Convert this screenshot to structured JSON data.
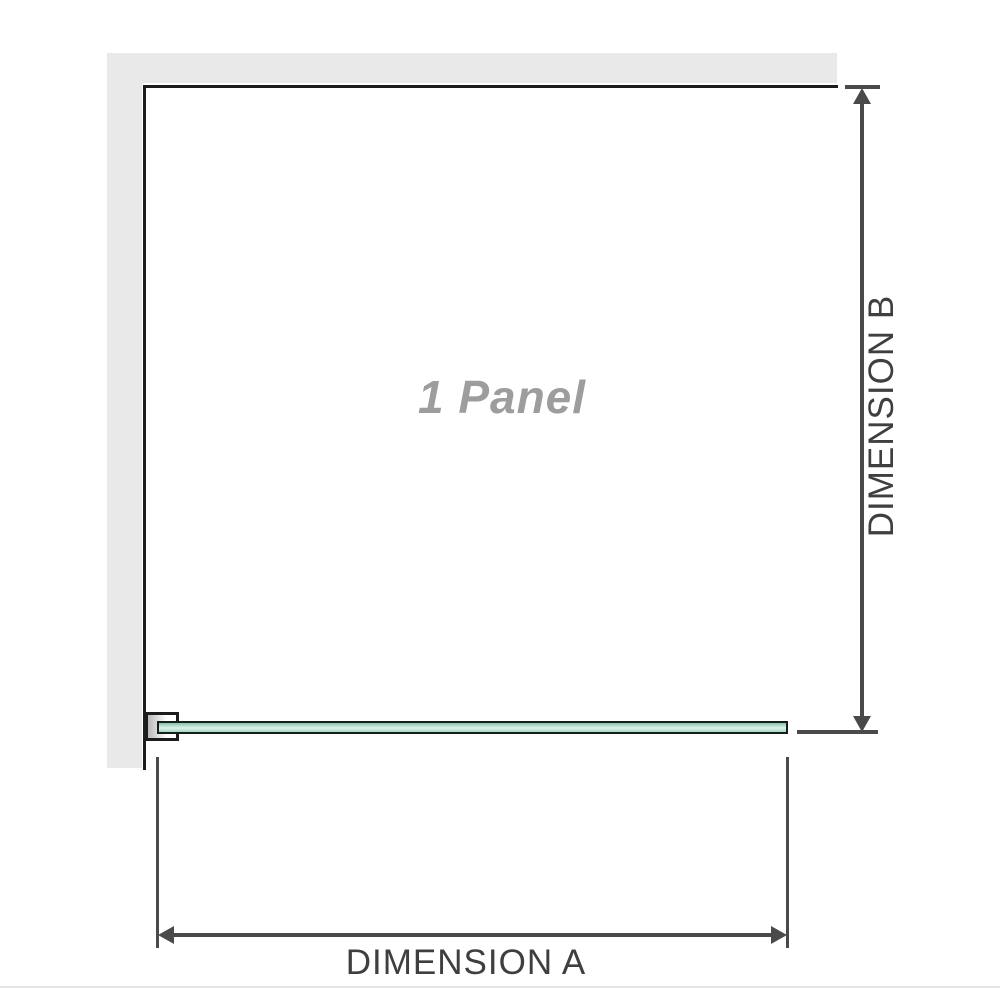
{
  "diagram": {
    "panel_label": "1 Panel",
    "dimension_a": {
      "label": "DIMENSION A"
    },
    "dimension_b": {
      "label": "DIMENSION B"
    }
  },
  "colors": {
    "background": "#ffffff",
    "wall_fill": "#e9e9e9",
    "outline": "#1c1c1c",
    "dimension_line": "#4a4a4a",
    "dimension_label": "#3f3f3f",
    "panel_label_color": "#9d9d9d",
    "glass_green_dark": "#7fc6a6",
    "glass_green_light": "#ddf2e9",
    "glass_green_mid": "#a5d8c2",
    "bracket_fill_start": "#b8b8b8",
    "baseline_rule": "#e4e4e1"
  }
}
